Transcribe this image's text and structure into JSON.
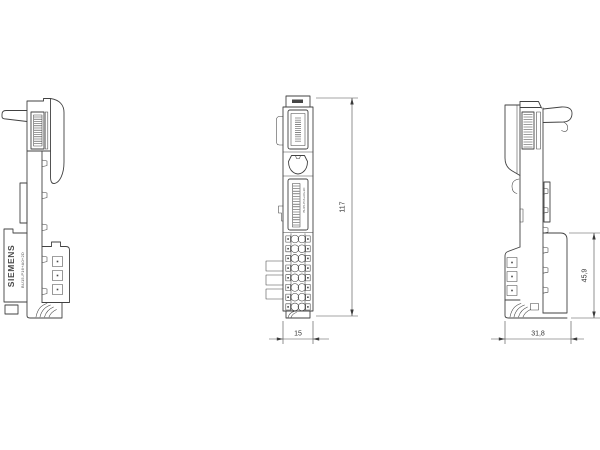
{
  "drawing": {
    "brand": "SIEMENS",
    "part_number": "BU15-P16+A0+2D",
    "front_marking": "BU15-P16+A0+2D",
    "dimensions": {
      "height": "117",
      "width": "15",
      "terminal_height": "45,9",
      "depth": "31,8"
    }
  }
}
